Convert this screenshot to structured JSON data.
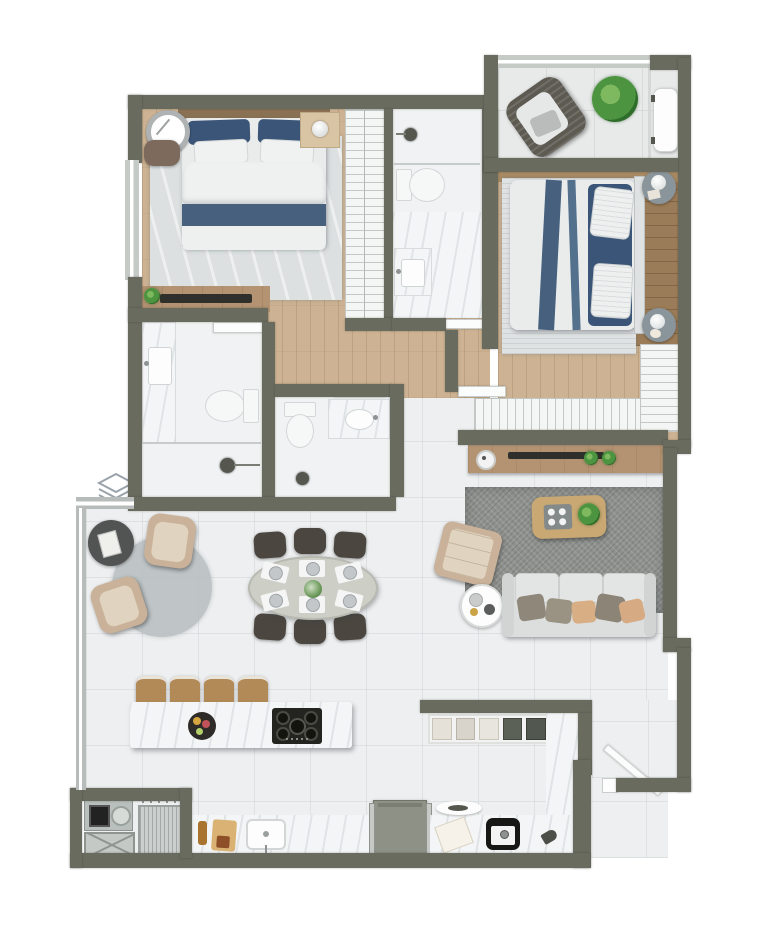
{
  "title": "apartment-floor-plan-top-view",
  "watermark": {
    "icon": "layers-diamond",
    "color": "#9aa3ab"
  },
  "palette": {
    "wall": "#696b5f",
    "window": "#c6cac7",
    "glass": "#b7bcba",
    "wood": "#cdb393",
    "wood-dark": "#9b7c58",
    "wood-mid": "#a98b64",
    "tile": "#edeff0",
    "balcony-tile": "#e8eaea",
    "marble": "#f3f5f6",
    "rug-light": "#dce0e1",
    "rug-stripe": "#dfe2e3",
    "rug-gray": "#8e918e",
    "rug-round": "#b7bec1",
    "linen": "#eaecec",
    "bed-blue": "#46607e",
    "pillow-blue": "#3a5577",
    "sofa": "#dcdedd",
    "pillow-gray": "#8f887a",
    "pillow-tan": "#d8ae85",
    "armchair": "#c9b299",
    "chair-dark": "#4b463f",
    "stool": "#b28a58",
    "console": "#b39372",
    "coffee": "#c9a873",
    "table-oval": "#cdcec6",
    "plant": "#4c9440",
    "cooktop": "#23241f",
    "tv": "#2f302c",
    "metal": "#b9bfbc",
    "appliance": "#8d9186",
    "washer": "#cbcfcd",
    "pouf": "#7d6a5c",
    "nightstand": "#8a959b",
    "clock": "#aeb2b3",
    "door": "#fbfcfc"
  },
  "rooms": [
    {
      "name": "bedroom-1",
      "items": [
        "double-bed",
        "headboard",
        "blue-pillows",
        "white-pillows",
        "blue-duvet-band",
        "wall-clock",
        "pouf",
        "nightstand",
        "table-lamp",
        "marble-area-rug",
        "dresser",
        "tv",
        "plant"
      ]
    },
    {
      "name": "wardrobe-1",
      "items": [
        "shelving-hatch"
      ]
    },
    {
      "name": "bathroom-1",
      "items": [
        "shower-head",
        "glass-screen",
        "toilet",
        "vanity-sink",
        "door"
      ]
    },
    {
      "name": "covered-balcony",
      "items": [
        "rattan-armchair",
        "potted-plant",
        "bench",
        "glass-partition",
        "window-band"
      ]
    },
    {
      "name": "bedroom-2",
      "items": [
        "double-bed",
        "headboard",
        "blue-runners",
        "pillows",
        "striped-rug",
        "round-nightstand-top",
        "table-lamp",
        "round-nightstand-bottom",
        "table-lamp"
      ]
    },
    {
      "name": "wardrobe-2",
      "items": [
        "l-shaped-shelving-hatch"
      ]
    },
    {
      "name": "hallway",
      "items": [
        "wood-floor",
        "bedroom2-door",
        "bathroom1-door"
      ]
    },
    {
      "name": "bathroom-2",
      "items": [
        "vanity-sink",
        "toilet",
        "shower-head",
        "door"
      ]
    },
    {
      "name": "bathroom-3",
      "items": [
        "toilet",
        "vanity-sink",
        "shower-head",
        "door"
      ]
    },
    {
      "name": "living-room",
      "items": [
        "tv-console",
        "tv",
        "speaker",
        "plants",
        "gray-rug",
        "coffee-table",
        "serving-tray",
        "plant",
        "lounge-chair",
        "round-side-table",
        "sofa",
        "throw-pillows-x5"
      ]
    },
    {
      "name": "dining-area",
      "items": [
        "oval-dining-table",
        "dining-chairs-x6",
        "place-settings-x6",
        "floral-centerpiece"
      ]
    },
    {
      "name": "sitting-nook",
      "items": [
        "round-rug",
        "armchair-top",
        "armchair-bottom",
        "dark-round-table",
        "book"
      ]
    },
    {
      "name": "kitchen",
      "items": [
        "island-counter",
        "bar-stools-x4",
        "gas-cooktop-5-burner",
        "fruit-bowl",
        "wall-shelf-unit",
        "oven-range",
        "counter-left",
        "counter-right",
        "counter-column",
        "kitchen-sink",
        "cutting-board",
        "bottle",
        "prep-sink",
        "napkin",
        "serving-dish",
        "scoop"
      ]
    },
    {
      "name": "laundry",
      "items": [
        "laundry-sink-unit",
        "utility-hatch",
        "washing-machine",
        "drying-rack"
      ]
    },
    {
      "name": "entry",
      "items": [
        "entry-door-diagonal",
        "door-jamb"
      ]
    }
  ]
}
